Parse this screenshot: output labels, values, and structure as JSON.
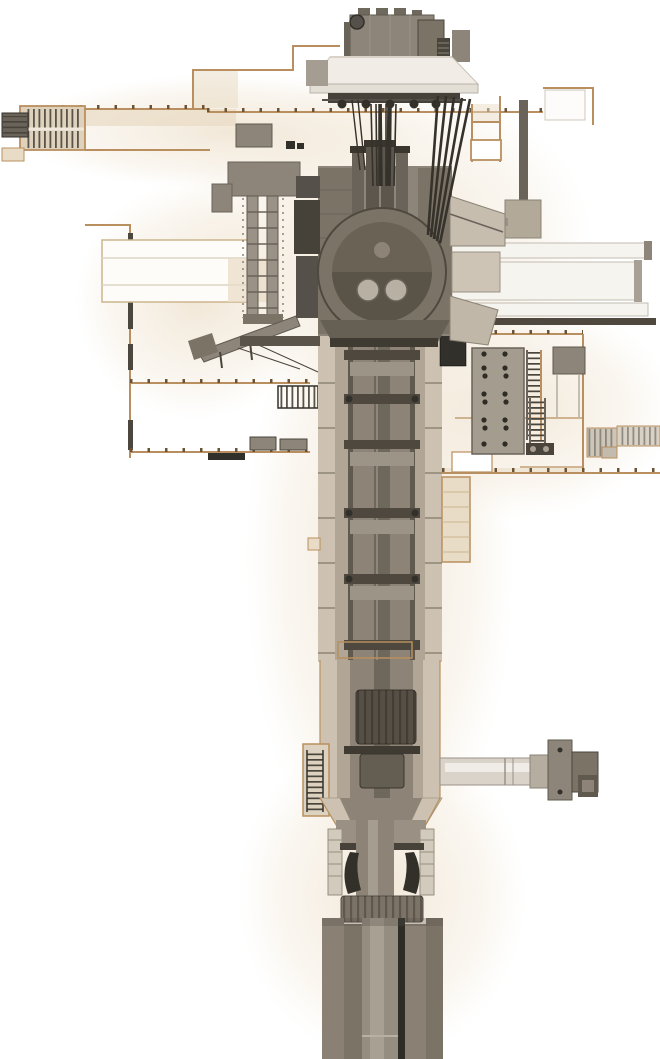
{
  "meta": {
    "title": "Sectional 3D render of a deep vertical shaft drilling machine and hoist building",
    "type": "technical-section-render",
    "description": "White background architectural section in tan outline containing a gray vertical drilling/hoisting machine: rooftop hoist house, suspended canopy with cable fan, rotary machine head, long segmented shaft with deck platforms, side access ladders and stairs, an electrical panel room at right, a horizontal side arm, and heavy casing columns descending off the bottom edge."
  },
  "colors": {
    "bg": "#ffffff",
    "glow": "#f0e5d3",
    "tan": "#b98f5f",
    "tick": "#6d5335",
    "beige": "#e9dcc6",
    "stair": "#ded2bd",
    "wall_dark": "#4b463e",
    "steel_light": "#cfc9be",
    "steel_mid": "#8d8579",
    "steel_mid2": "#7b7366",
    "steel_dark": "#6a635a",
    "steel_darker": "#4a453c",
    "near_black": "#32302a",
    "cable": "#35312b",
    "white_beam": "#f6f4ef",
    "shaft_wall": "#cdc2b1",
    "shaft_inner": "#b1a696",
    "column_mid": "#8d8477",
    "pipe": "#6e675c",
    "drum": "#564f45",
    "arm_light": "#d9d3ca"
  },
  "parts": {
    "upper_works": [
      "hoist-house",
      "crown-sheave",
      "roof-units",
      "canopy",
      "canopy-trolleys",
      "hoist-cable-bundle",
      "guide-cable-fan"
    ],
    "building": [
      "upper-floor-line",
      "stairwell-upper-left",
      "annex-outline",
      "top-right-room",
      "left-wall",
      "white-duct",
      "mid-floor-lines",
      "far-left-stairs"
    ],
    "machine": [
      "rail-tower",
      "conveyor-boom",
      "machine-head",
      "rotary-drum",
      "pipe-cluster",
      "monorail-beams",
      "support-post"
    ],
    "right_room": [
      "electrical-panel",
      "panel-ladder",
      "equipment-box",
      "right-stairs",
      "access-ladder",
      "main-floor-slab"
    ],
    "shaft": [
      "shaft-casing",
      "deck-platform-bands",
      "service-collar",
      "lower-drums",
      "side-arm",
      "arm-drive-unit",
      "ladder-box",
      "funnel-transition",
      "flange-stacks",
      "ribbed-collar",
      "bottom-columns"
    ]
  }
}
